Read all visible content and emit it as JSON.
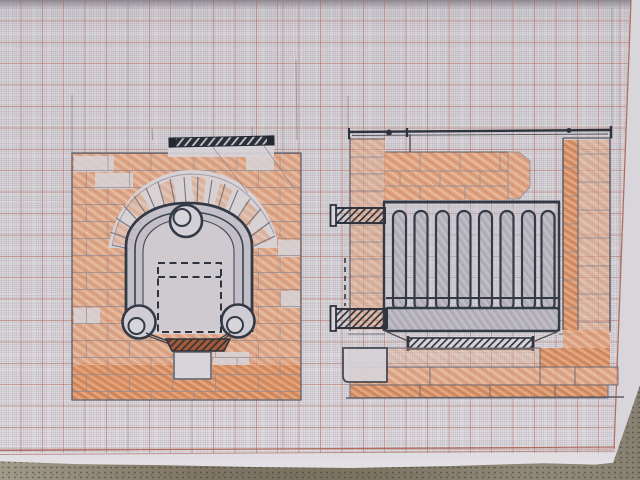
{
  "scene": {
    "subject": "photograph of hand-drawn brick stove plans sketched in pencil and orange crayon on millimetre graph paper lying on a table",
    "left_view": "front elevation: brick surround with arched stove door, fan of voussoir bricks, steel lintel bar, round hinge bosses, dashed firebox outline, hatched grate and pedestal",
    "right_view": "cross-section: brick flue enclosure with top rod, tube heat-exchanger radiator on a plinth, inlet and outlet pipe stubs, hatched grate and stepped brick base"
  },
  "palette": {
    "paper": "#d7d4d9",
    "grid_minor": "#8c7d8a",
    "grid_major": "#b06a58",
    "printed_margin": "#a85f50",
    "pencil_line": "#6e6b76",
    "ink_dark": "#323945",
    "brick": "#e2a17b",
    "brick_strong": "#d98f63",
    "pencil_gray": "#b7b4bd",
    "grate_rust": "#a0522d",
    "table": "#928c7d"
  },
  "counts": {
    "radiator_tubes": 8,
    "fan_voussoir_lines": 17,
    "hinge_bosses": 2,
    "pipe_stubs": 2
  }
}
